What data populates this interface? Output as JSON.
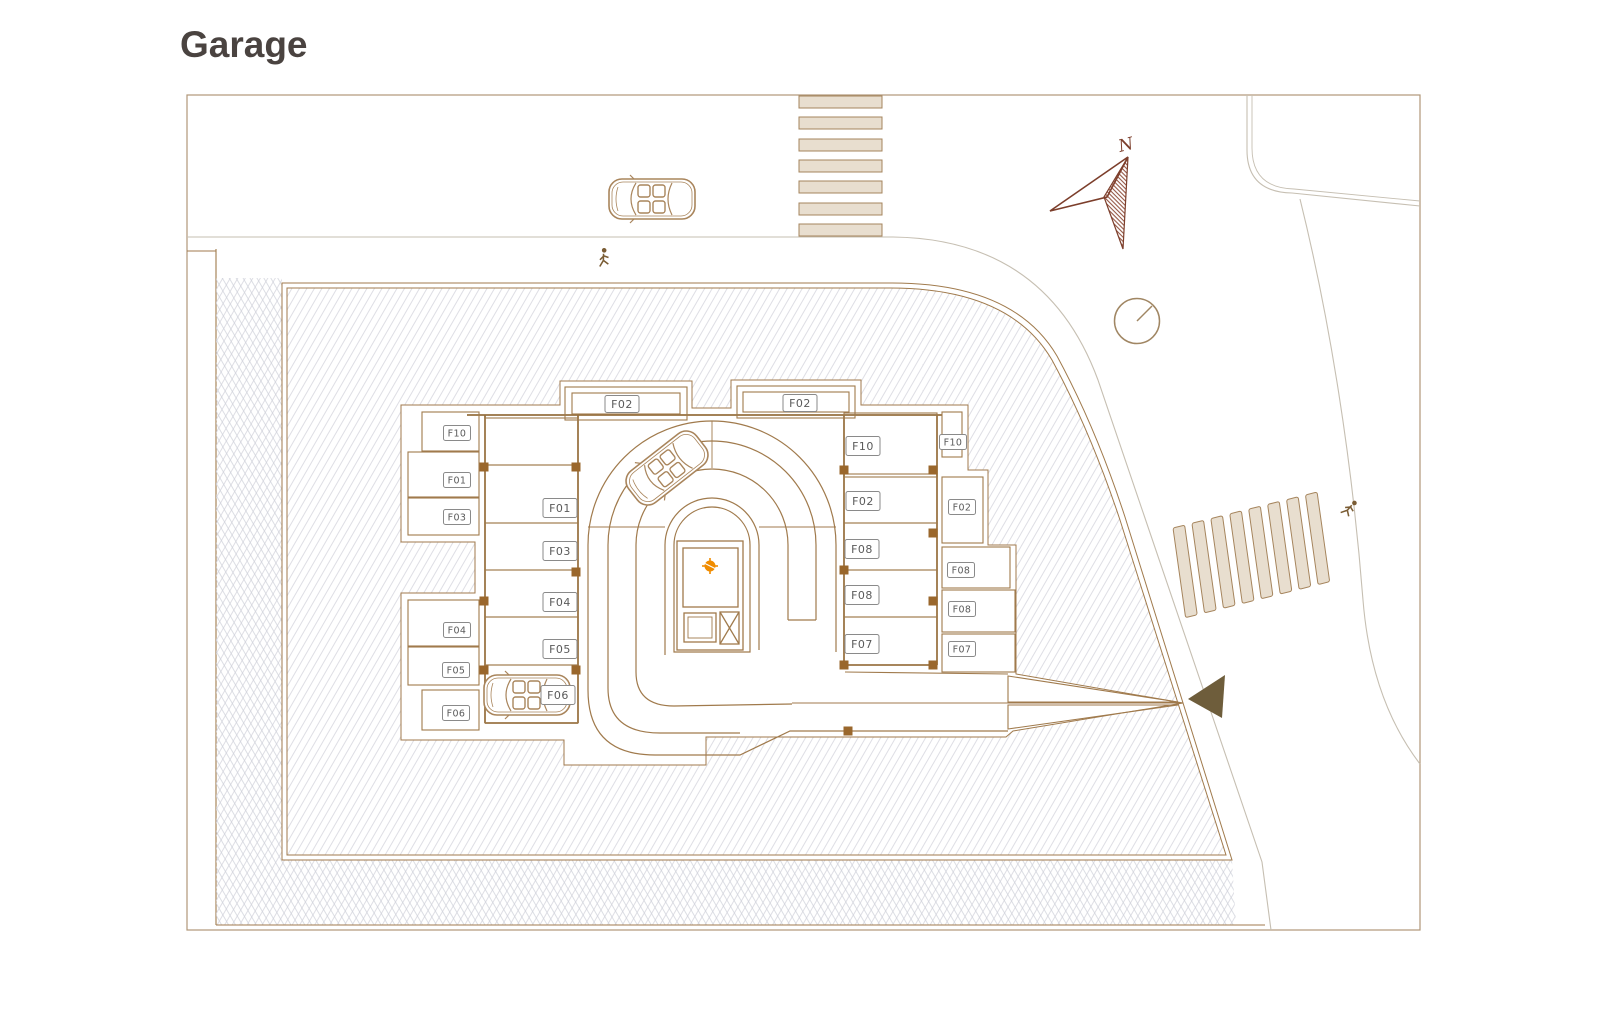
{
  "header": {
    "title": "Garage"
  },
  "plan": {
    "compass": {
      "label": "N"
    },
    "parking_labels": {
      "outer_left": [
        "F10",
        "F01",
        "F03",
        "F04",
        "F05",
        "F06"
      ],
      "inner_left": [
        "F01",
        "F03",
        "F04",
        "F05",
        "F06"
      ],
      "carports_top": [
        "F02",
        "F02"
      ],
      "inner_right": [
        "F10",
        "F02",
        "F08",
        "F08",
        "F07"
      ],
      "outer_right": [
        "F10",
        "F02",
        "F08",
        "F08",
        "F07"
      ]
    },
    "icons": [
      "north-compass-icon",
      "clock-circle-icon",
      "pedestrian-icon",
      "car-icon",
      "entry-arrow-icon",
      "crosswalk",
      "elevator-icon",
      "stair-core-marker"
    ],
    "colors": {
      "line_brown": "#a07a4c",
      "wall_brown": "#96713f",
      "label_text": "#5a5a5a",
      "hatch_gray": "#d6d6de",
      "stripe_fill": "#e8decf",
      "road_gray": "#c6bfb2",
      "compass_red": "#7c3e2b",
      "arrow_olive": "#6e5d3b",
      "accent_orange": "#f08c00",
      "title_color": "#4a4340"
    }
  }
}
